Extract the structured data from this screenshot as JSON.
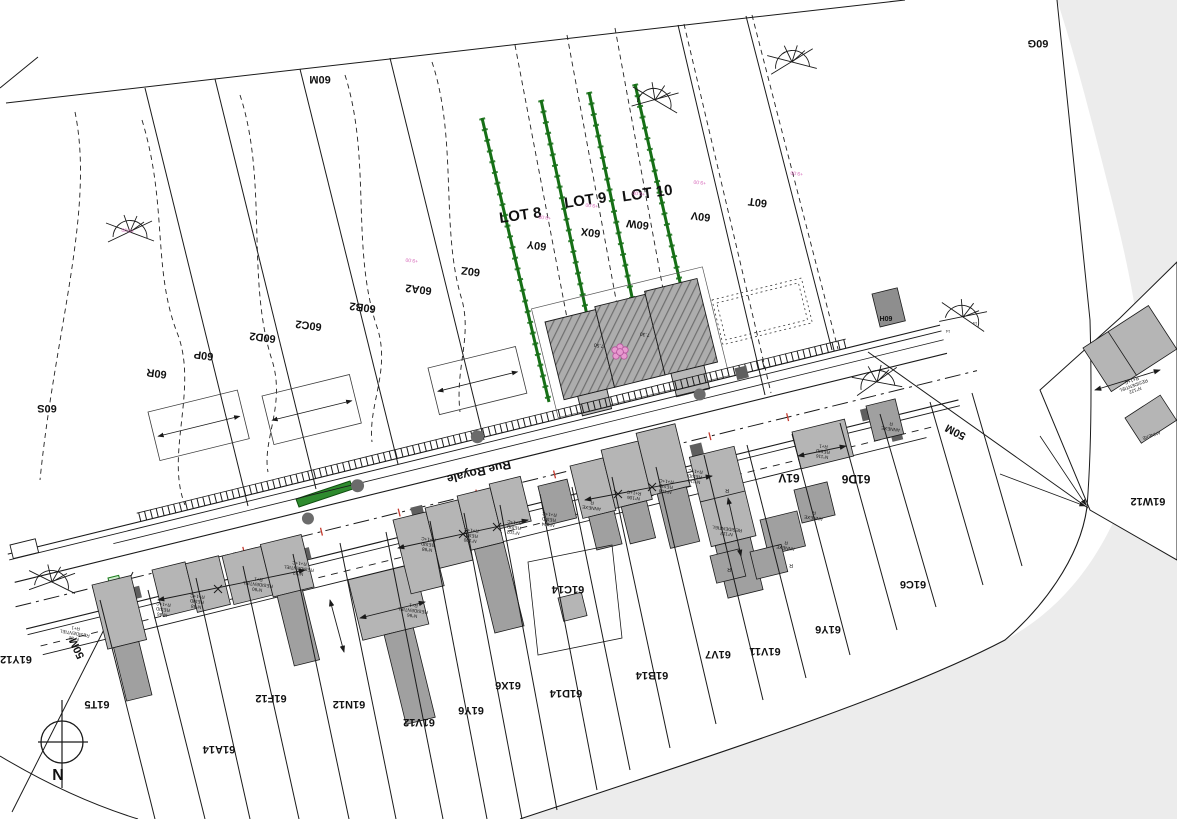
{
  "map": {
    "type": "cadastral-site-plan",
    "street": {
      "name": "Rue Royale"
    },
    "colors": {
      "line": "#1a1a1a",
      "outside_area": "#ececec",
      "lot_boundary_green": "#166f16",
      "green_island": "#2e8b2e",
      "building_fill": "#b5b5b5",
      "annex_fill": "#a0a0a0",
      "measure_pink": "#d667b8",
      "survey_red": "#c43a2e"
    },
    "label_groups": {
      "lots": [
        {
          "name": "lot-8-label",
          "text": "LOT 8",
          "x": 521,
          "y": 220,
          "rot": -8,
          "size": 15,
          "bold": true
        },
        {
          "name": "lot-9-label",
          "text": "LOT 9",
          "x": 586,
          "y": 205,
          "rot": -8,
          "size": 15,
          "bold": true
        },
        {
          "name": "lot-10-label",
          "text": "LOT 10",
          "x": 648,
          "y": 198,
          "rot": -8,
          "size": 15,
          "bold": true
        }
      ],
      "upper_parcels": [
        {
          "name": "parcel-60m",
          "text": "60M",
          "x": 320,
          "y": 76,
          "rot": 180,
          "size": 11,
          "bold": true
        },
        {
          "name": "parcel-60g",
          "text": "60G",
          "x": 1038,
          "y": 40,
          "rot": 180,
          "size": 11,
          "bold": true
        },
        {
          "name": "parcel-60s",
          "text": "60S",
          "x": 47,
          "y": 405,
          "rot": 180,
          "size": 11,
          "bold": true
        },
        {
          "name": "parcel-60r",
          "text": "60R",
          "x": 157,
          "y": 370,
          "rot": 187,
          "size": 11,
          "bold": true
        },
        {
          "name": "parcel-60p",
          "text": "60P",
          "x": 204,
          "y": 352,
          "rot": 187,
          "size": 11,
          "bold": true
        },
        {
          "name": "parcel-60d2",
          "text": "60D2",
          "x": 263,
          "y": 334,
          "rot": 187,
          "size": 11,
          "bold": true
        },
        {
          "name": "parcel-60c2",
          "text": "60C2",
          "x": 309,
          "y": 322,
          "rot": 187,
          "size": 11,
          "bold": true
        },
        {
          "name": "parcel-60b2",
          "text": "60B2",
          "x": 363,
          "y": 304,
          "rot": 187,
          "size": 11,
          "bold": true
        },
        {
          "name": "parcel-60a2",
          "text": "60A2",
          "x": 419,
          "y": 286,
          "rot": 187,
          "size": 11,
          "bold": true
        },
        {
          "name": "parcel-60z",
          "text": "60Z",
          "x": 471,
          "y": 268,
          "rot": 187,
          "size": 11,
          "bold": true
        },
        {
          "name": "parcel-60y",
          "text": "60Y",
          "x": 537,
          "y": 242,
          "rot": 187,
          "size": 11,
          "bold": true
        },
        {
          "name": "parcel-60x",
          "text": "60X",
          "x": 591,
          "y": 229,
          "rot": 187,
          "size": 11,
          "bold": true
        },
        {
          "name": "parcel-60w",
          "text": "60W",
          "x": 638,
          "y": 221,
          "rot": 187,
          "size": 11,
          "bold": true
        },
        {
          "name": "parcel-60v",
          "text": "60V",
          "x": 701,
          "y": 213,
          "rot": 187,
          "size": 11,
          "bold": true
        },
        {
          "name": "parcel-60t",
          "text": "60T",
          "x": 758,
          "y": 199,
          "rot": 187,
          "size": 11,
          "bold": true
        },
        {
          "name": "parcel-60h",
          "text": "60H",
          "x": 886,
          "y": 316,
          "rot": 180,
          "size": 7,
          "bold": true
        }
      ],
      "lower_parcels": [
        {
          "name": "parcel-61y12",
          "text": "61Y12",
          "x": 16,
          "y": 656,
          "rot": 180,
          "size": 11,
          "bold": true
        },
        {
          "name": "parcel-61t5",
          "text": "61T5",
          "x": 97,
          "y": 701,
          "rot": 180,
          "size": 11,
          "bold": true
        },
        {
          "name": "parcel-61a14",
          "text": "61A14",
          "x": 219,
          "y": 746,
          "rot": 180,
          "size": 11,
          "bold": true
        },
        {
          "name": "parcel-61f12",
          "text": "61F12",
          "x": 271,
          "y": 695,
          "rot": 180,
          "size": 11,
          "bold": true
        },
        {
          "name": "parcel-61n12",
          "text": "61N12",
          "x": 349,
          "y": 701,
          "rot": 180,
          "size": 11,
          "bold": true
        },
        {
          "name": "parcel-61v12",
          "text": "61V12",
          "x": 419,
          "y": 719,
          "rot": 180,
          "size": 11,
          "bold": true
        },
        {
          "name": "parcel-61y6",
          "text": "61Y6",
          "x": 471,
          "y": 707,
          "rot": 180,
          "size": 11,
          "bold": true
        },
        {
          "name": "parcel-61x6",
          "text": "61X6",
          "x": 508,
          "y": 682,
          "rot": 180,
          "size": 11,
          "bold": true
        },
        {
          "name": "parcel-61d14",
          "text": "61D14",
          "x": 566,
          "y": 690,
          "rot": 180,
          "size": 11,
          "bold": true
        },
        {
          "name": "parcel-61b14",
          "text": "61B14",
          "x": 652,
          "y": 672,
          "rot": 180,
          "size": 11,
          "bold": true
        },
        {
          "name": "parcel-61c14",
          "text": "61C14",
          "x": 568,
          "y": 586,
          "rot": 180,
          "size": 11,
          "bold": true
        },
        {
          "name": "parcel-61v7",
          "text": "61V7",
          "x": 718,
          "y": 651,
          "rot": 180,
          "size": 11,
          "bold": true
        },
        {
          "name": "parcel-61v11",
          "text": "61V11",
          "x": 765,
          "y": 648,
          "rot": 180,
          "size": 11,
          "bold": true
        },
        {
          "name": "parcel-61y6-b",
          "text": "61Y6",
          "x": 828,
          "y": 626,
          "rot": 180,
          "size": 11,
          "bold": true
        },
        {
          "name": "parcel-61c6",
          "text": "61C6",
          "x": 913,
          "y": 581,
          "rot": 180,
          "size": 11,
          "bold": true
        },
        {
          "name": "parcel-61v",
          "text": "61V",
          "x": 789,
          "y": 474,
          "rot": 180,
          "size": 12,
          "bold": true
        },
        {
          "name": "parcel-61d6",
          "text": "61D6",
          "x": 856,
          "y": 475,
          "rot": 180,
          "size": 12,
          "bold": true
        },
        {
          "name": "parcel-61w12",
          "text": "61W12",
          "x": 1148,
          "y": 498,
          "rot": 180,
          "size": 11,
          "bold": true
        }
      ],
      "street_labels": [
        {
          "name": "street-name",
          "text": "Rue Royale",
          "x": 478,
          "y": 468,
          "rot": 166.5,
          "size": 12,
          "bold": true
        },
        {
          "name": "dim-50m-right",
          "text": "50M",
          "x": 957,
          "y": 429,
          "rot": 207,
          "size": 11,
          "bold": true
        },
        {
          "name": "dim-50m-left",
          "text": "50M",
          "x": 80,
          "y": 647,
          "rot": 245,
          "size": 11,
          "bold": true
        },
        {
          "name": "north-letter",
          "text": "N",
          "x": 58,
          "y": 780,
          "rot": 0,
          "size": 16,
          "bold": true
        }
      ],
      "buildings": [
        {
          "name": "bldg-n82",
          "lines": [
            "N°82",
            "RESIDENTIEL",
            "R+1"
          ],
          "x": 75,
          "y": 632,
          "rot": 190,
          "size": 4.6
        },
        {
          "name": "bldg-n86",
          "lines": [
            "N°86",
            "RESID",
            "R+1+C"
          ],
          "x": 163,
          "y": 608,
          "rot": 187,
          "size": 4.6
        },
        {
          "name": "bldg-n88",
          "lines": [
            "N°88",
            "RESID",
            "R+1+C"
          ],
          "x": 197,
          "y": 600,
          "rot": 187,
          "size": 4.6
        },
        {
          "name": "bldg-n90",
          "lines": [
            "N°90",
            "RESIDENTIEL",
            "R+1"
          ],
          "x": 258,
          "y": 583,
          "rot": 187,
          "size": 4.6
        },
        {
          "name": "bldg-n92",
          "lines": [
            "N°92",
            "RESIDENTIEL",
            "R+1+C"
          ],
          "x": 299,
          "y": 567,
          "rot": 187,
          "size": 4.6
        },
        {
          "name": "bldg-n96",
          "lines": [
            "N°96",
            "RESIDENTIEL",
            "R+1"
          ],
          "x": 413,
          "y": 609,
          "rot": 187,
          "size": 4.6
        },
        {
          "name": "bldg-n98",
          "lines": [
            "N°98",
            "RESID",
            "R+1+C"
          ],
          "x": 428,
          "y": 543,
          "rot": 187,
          "size": 4.6
        },
        {
          "name": "bldg-n100",
          "lines": [
            "N°100",
            "RESID",
            "R+1+C"
          ],
          "x": 471,
          "y": 534,
          "rot": 187,
          "size": 4.6
        },
        {
          "name": "bldg-n102",
          "lines": [
            "N°102",
            "RESID",
            "R+1+C"
          ],
          "x": 514,
          "y": 526,
          "rot": 187,
          "size": 4.6
        },
        {
          "name": "bldg-n104",
          "lines": [
            "N°104",
            "RESID",
            "R+1+C"
          ],
          "x": 549,
          "y": 518,
          "rot": 187,
          "size": 4.6
        },
        {
          "name": "bldg-n106",
          "lines": [
            "N°106",
            "R+1+C"
          ],
          "x": 634,
          "y": 494,
          "rot": 187,
          "size": 4.6
        },
        {
          "name": "bldg-n108",
          "lines": [
            "N°108",
            "RESID",
            "R+1+C"
          ],
          "x": 666,
          "y": 485,
          "rot": 187,
          "size": 4.6
        },
        {
          "name": "bldg-n110",
          "lines": [
            "N°110",
            "RESID",
            "R+1+C"
          ],
          "x": 695,
          "y": 475,
          "rot": 187,
          "size": 4.6
        },
        {
          "name": "bldg-n112",
          "lines": [
            "N°112",
            "RESIDENTIEL"
          ],
          "x": 727,
          "y": 530,
          "rot": 187,
          "size": 4.6
        },
        {
          "name": "bldg-n116",
          "lines": [
            "N°116",
            "RESID",
            "R+1"
          ],
          "x": 823,
          "y": 450,
          "rot": 187,
          "size": 4.6
        },
        {
          "name": "bldg-n122",
          "lines": [
            "N°122",
            "RESIDENTIEL",
            "R+1+C"
          ],
          "x": 1133,
          "y": 384,
          "rot": 160,
          "size": 4.6
        },
        {
          "name": "bldg-annexe-1",
          "lines": [
            "ANNEXE",
            "R"
          ],
          "x": 592,
          "y": 504,
          "rot": 187,
          "size": 4.6
        },
        {
          "name": "bldg-annexe-2",
          "lines": [
            "ANNEXE",
            "R"
          ],
          "x": 814,
          "y": 514,
          "rot": 187,
          "size": 4.6
        },
        {
          "name": "bldg-annexe-3",
          "lines": [
            "ANNEXE",
            "R"
          ],
          "x": 786,
          "y": 544,
          "rot": 187,
          "size": 4.6
        },
        {
          "name": "bldg-annexe-4",
          "lines": [
            "ANNEXE",
            "R"
          ],
          "x": 891,
          "y": 425,
          "rot": 187,
          "size": 4.6
        },
        {
          "name": "bldg-annexe-5",
          "lines": [
            "ANNEXE"
          ],
          "x": 1151,
          "y": 434,
          "rot": 160,
          "size": 4.6
        },
        {
          "name": "bldg-r-1",
          "text": "R",
          "x": 727,
          "y": 489,
          "rot": 180,
          "size": 5
        },
        {
          "name": "bldg-r-2",
          "text": "R",
          "x": 729,
          "y": 568,
          "rot": 180,
          "size": 5
        },
        {
          "name": "bldg-r-3",
          "text": "R",
          "x": 791,
          "y": 564,
          "rot": 180,
          "size": 5
        }
      ],
      "dimensions": [
        {
          "name": "dim-750",
          "text": "7.50",
          "x": 599,
          "y": 344,
          "rot": 187,
          "size": 5
        },
        {
          "name": "dim-730",
          "text": "7.30",
          "x": 645,
          "y": 333,
          "rot": 187,
          "size": 5
        },
        {
          "name": "level-1",
          "text": "+9.00",
          "x": 412,
          "y": 259,
          "rot": 187,
          "size": 5,
          "color": "#d667b8"
        },
        {
          "name": "level-2",
          "text": "+9.00",
          "x": 545,
          "y": 216,
          "rot": 187,
          "size": 5,
          "color": "#d667b8"
        },
        {
          "name": "level-3",
          "text": "+9.00",
          "x": 592,
          "y": 204,
          "rot": 187,
          "size": 5,
          "color": "#d667b8"
        },
        {
          "name": "level-4",
          "text": "+9.00",
          "x": 639,
          "y": 192,
          "rot": 187,
          "size": 5,
          "color": "#d667b8"
        },
        {
          "name": "level-5",
          "text": "+9.00",
          "x": 700,
          "y": 181,
          "rot": 187,
          "size": 5,
          "color": "#d667b8"
        },
        {
          "name": "level-6",
          "text": "+9.00",
          "x": 128,
          "y": 229,
          "rot": 187,
          "size": 5,
          "color": "#d667b8"
        },
        {
          "name": "level-7",
          "text": "+9.00",
          "x": 797,
          "y": 172,
          "rot": 187,
          "size": 5,
          "color": "#d667b8"
        },
        {
          "name": "fan-num-1",
          "text": "14",
          "x": 948,
          "y": 330,
          "rot": 180,
          "size": 4
        },
        {
          "name": "fan-num-2",
          "text": "14",
          "x": 975,
          "y": 322,
          "rot": 180,
          "size": 4
        }
      ]
    }
  }
}
